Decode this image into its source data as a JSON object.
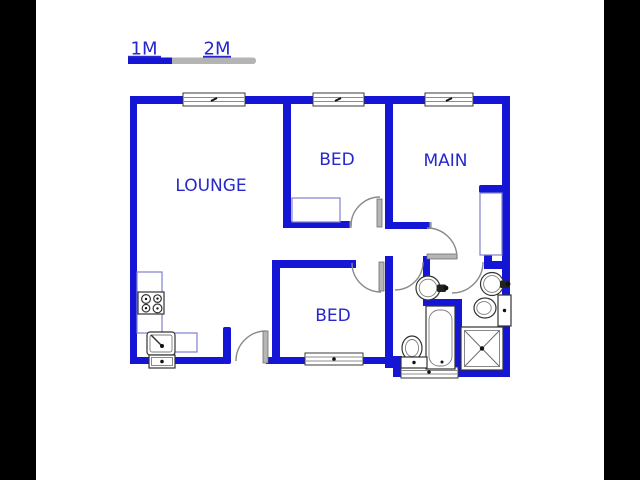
{
  "window": {
    "pillar_color": "#000000",
    "paper_color": "#ffffff"
  },
  "scale_bar": {
    "label_1m": "1M",
    "label_2m": "2M",
    "bar_blue": "#1515d6",
    "bar_gray": "#b4b4b4"
  },
  "plan": {
    "wall_color": "#1515d6",
    "label_color": "#2727cb",
    "rooms": [
      {
        "id": "lounge",
        "label": "LOUNGE"
      },
      {
        "id": "bedroom-top",
        "label": "BED"
      },
      {
        "id": "main-bedroom",
        "label": "MAIN"
      },
      {
        "id": "bedroom-lower",
        "label": "BED"
      }
    ],
    "fixtures": [
      {
        "name": "stove-icon"
      },
      {
        "name": "kitchen-sink-icon"
      },
      {
        "name": "counter"
      },
      {
        "name": "closet"
      },
      {
        "name": "wardrobe"
      },
      {
        "name": "bathtub-icon"
      },
      {
        "name": "toilet-icon"
      },
      {
        "name": "washbasin-icon"
      },
      {
        "name": "washbasin-icon"
      },
      {
        "name": "toilet-icon"
      },
      {
        "name": "shower-icon"
      }
    ]
  }
}
